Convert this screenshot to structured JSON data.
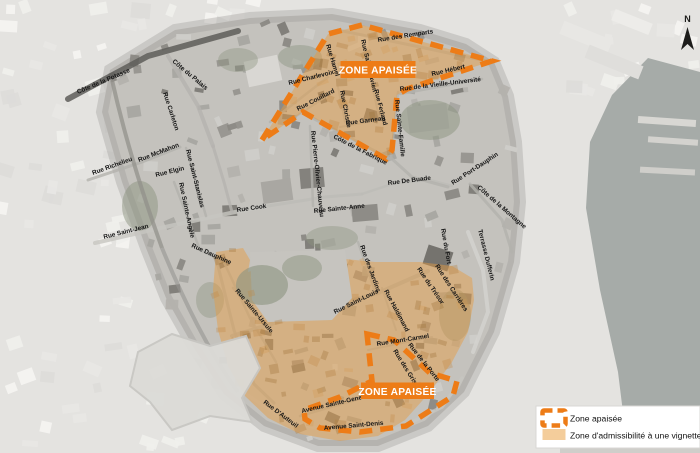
{
  "map_title": "Zones apaisées du Vieux-Québec",
  "zones": {
    "top_label": "ZONE APAISÉE",
    "bottom_label": "ZONE APAISÉE"
  },
  "legend": {
    "items": [
      {
        "icon": "dashed-zone-outline-icon",
        "label": "Zone apaisée"
      },
      {
        "icon": "filled-zone-swatch-icon",
        "label": "Zone d'admissibilité à une vignette"
      }
    ]
  },
  "compass": {
    "label": "N"
  },
  "colors": {
    "accent_orange": "#ED7C17",
    "zone_overlay": "rgba(230,155,64,0.46)",
    "vignette_fill": "#F4CD9B"
  },
  "streets": [
    "Côte de la Potasse",
    "Côte du Palais",
    "Rue Carleton",
    "Rue McMahon",
    "Rue Richelieu",
    "Rue Elgin",
    "Rue Saint-Stanislas",
    "Rue Sainte-Angèle",
    "Rue Saint-Jean",
    "Rue Dauphine",
    "Rue Cook",
    "Rue Sainte-Anne",
    "Rue Pierre-Olivier-Chauveau",
    "Côte de la Fabrique",
    "Rue Charlevoix",
    "Rue Hamel",
    "Rue Saint-Flavien",
    "Rue des Remparts",
    "Rue Couillard",
    "Rue Christie",
    "Rue Ferland",
    "Rue Garneau",
    "Rue Hébert",
    "Rue de la Vieille-Université",
    "Rue Sainte-Famille",
    "Rue Port-Dauphin",
    "Côte de la Montagne",
    "Rue De Buade",
    "Rue du Fort",
    "Terrasse Dufferin",
    "Rue du Trésor",
    "Rue des Carrières",
    "Rue des Jardins",
    "Rue Saint-Louis",
    "Rue Sainte-Ursule",
    "Rue Haldimand",
    "Rue Mont-Carmel",
    "Rue de la Porte",
    "Rue des Grisons",
    "Rue D'Auteuil",
    "Avenue Sainte-Geneviève",
    "Avenue Saint-Denis"
  ]
}
